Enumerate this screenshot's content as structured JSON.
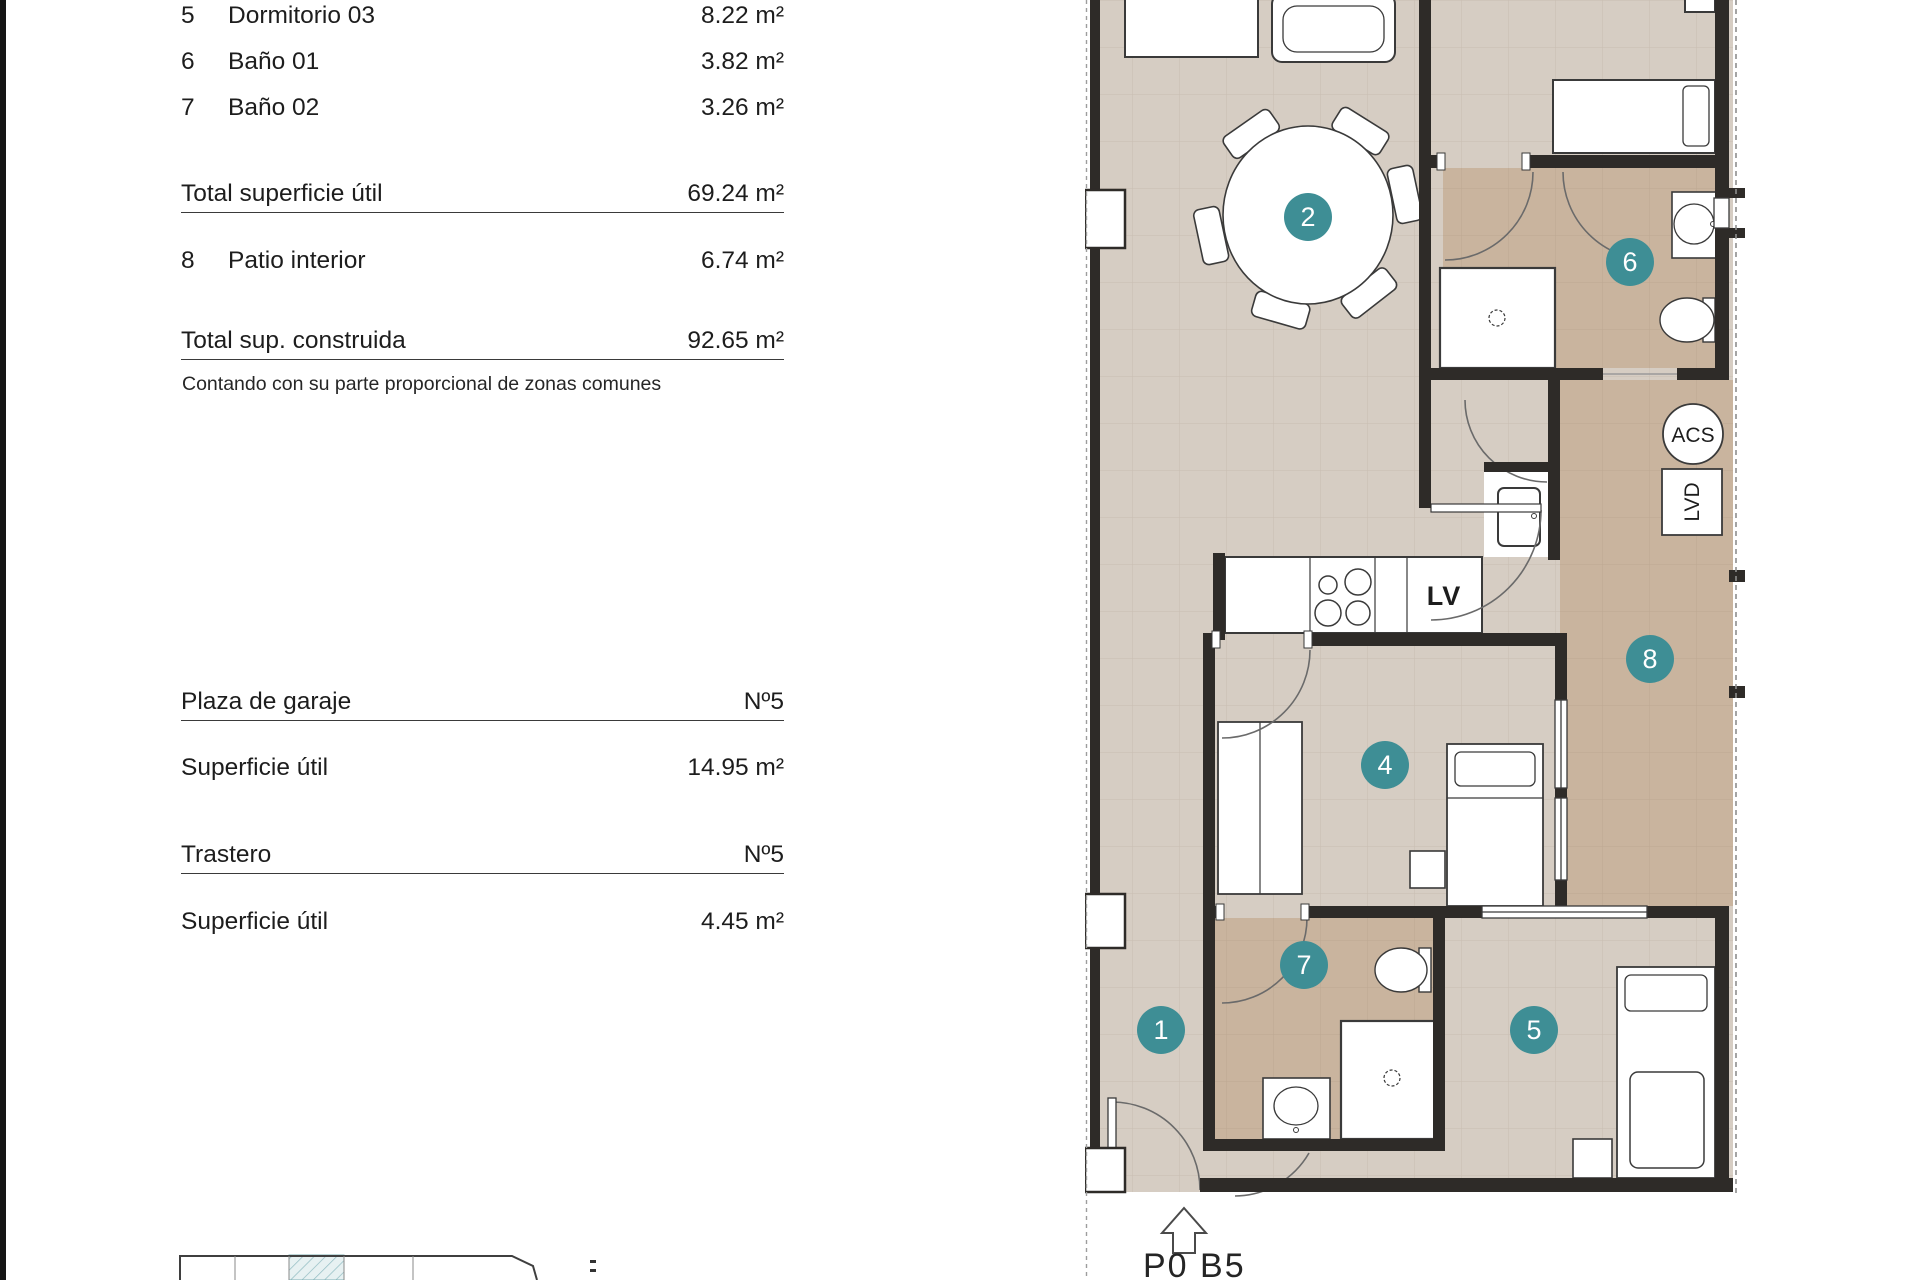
{
  "panel": {
    "rows": [
      {
        "num": "5",
        "label": "Dormitorio 03",
        "value": "8.22 m²"
      },
      {
        "num": "6",
        "label": "Baño 01",
        "value": "3.82 m²"
      },
      {
        "num": "7",
        "label": "Baño 02",
        "value": "3.26 m²"
      }
    ],
    "total_util": {
      "label": "Total superficie útil",
      "value": "69.24 m²"
    },
    "patio_row": {
      "num": "8",
      "label": "Patio interior",
      "value": "6.74 m²"
    },
    "total_built": {
      "label": "Total sup. construida",
      "value": "92.65 m²"
    },
    "note": "Contando con su parte proporcional de zonas comunes",
    "garage": {
      "label": "Plaza de garaje",
      "value": "Nº5"
    },
    "garage_area": {
      "label": "Superficie útil",
      "value": "14.95 m²"
    },
    "storage": {
      "label": "Trastero",
      "value": "Nº5"
    },
    "storage_area": {
      "label": "Superficie útil",
      "value": "4.45 m²"
    }
  },
  "plan": {
    "sheet": "P0 B5",
    "labels": {
      "acs": "ACS",
      "lvd": "LVD",
      "lv": "LV"
    },
    "markers": {
      "m1": "1",
      "m2": "2",
      "m4": "4",
      "m5": "5",
      "m6": "6",
      "m7": "7",
      "m8": "8"
    }
  },
  "colors": {
    "floor": "#d6cdc3",
    "bath_floor": "#c9b49e",
    "wall": "#2e2b28",
    "marker": "#3e8e95",
    "hatch": "#8fbcc1"
  }
}
